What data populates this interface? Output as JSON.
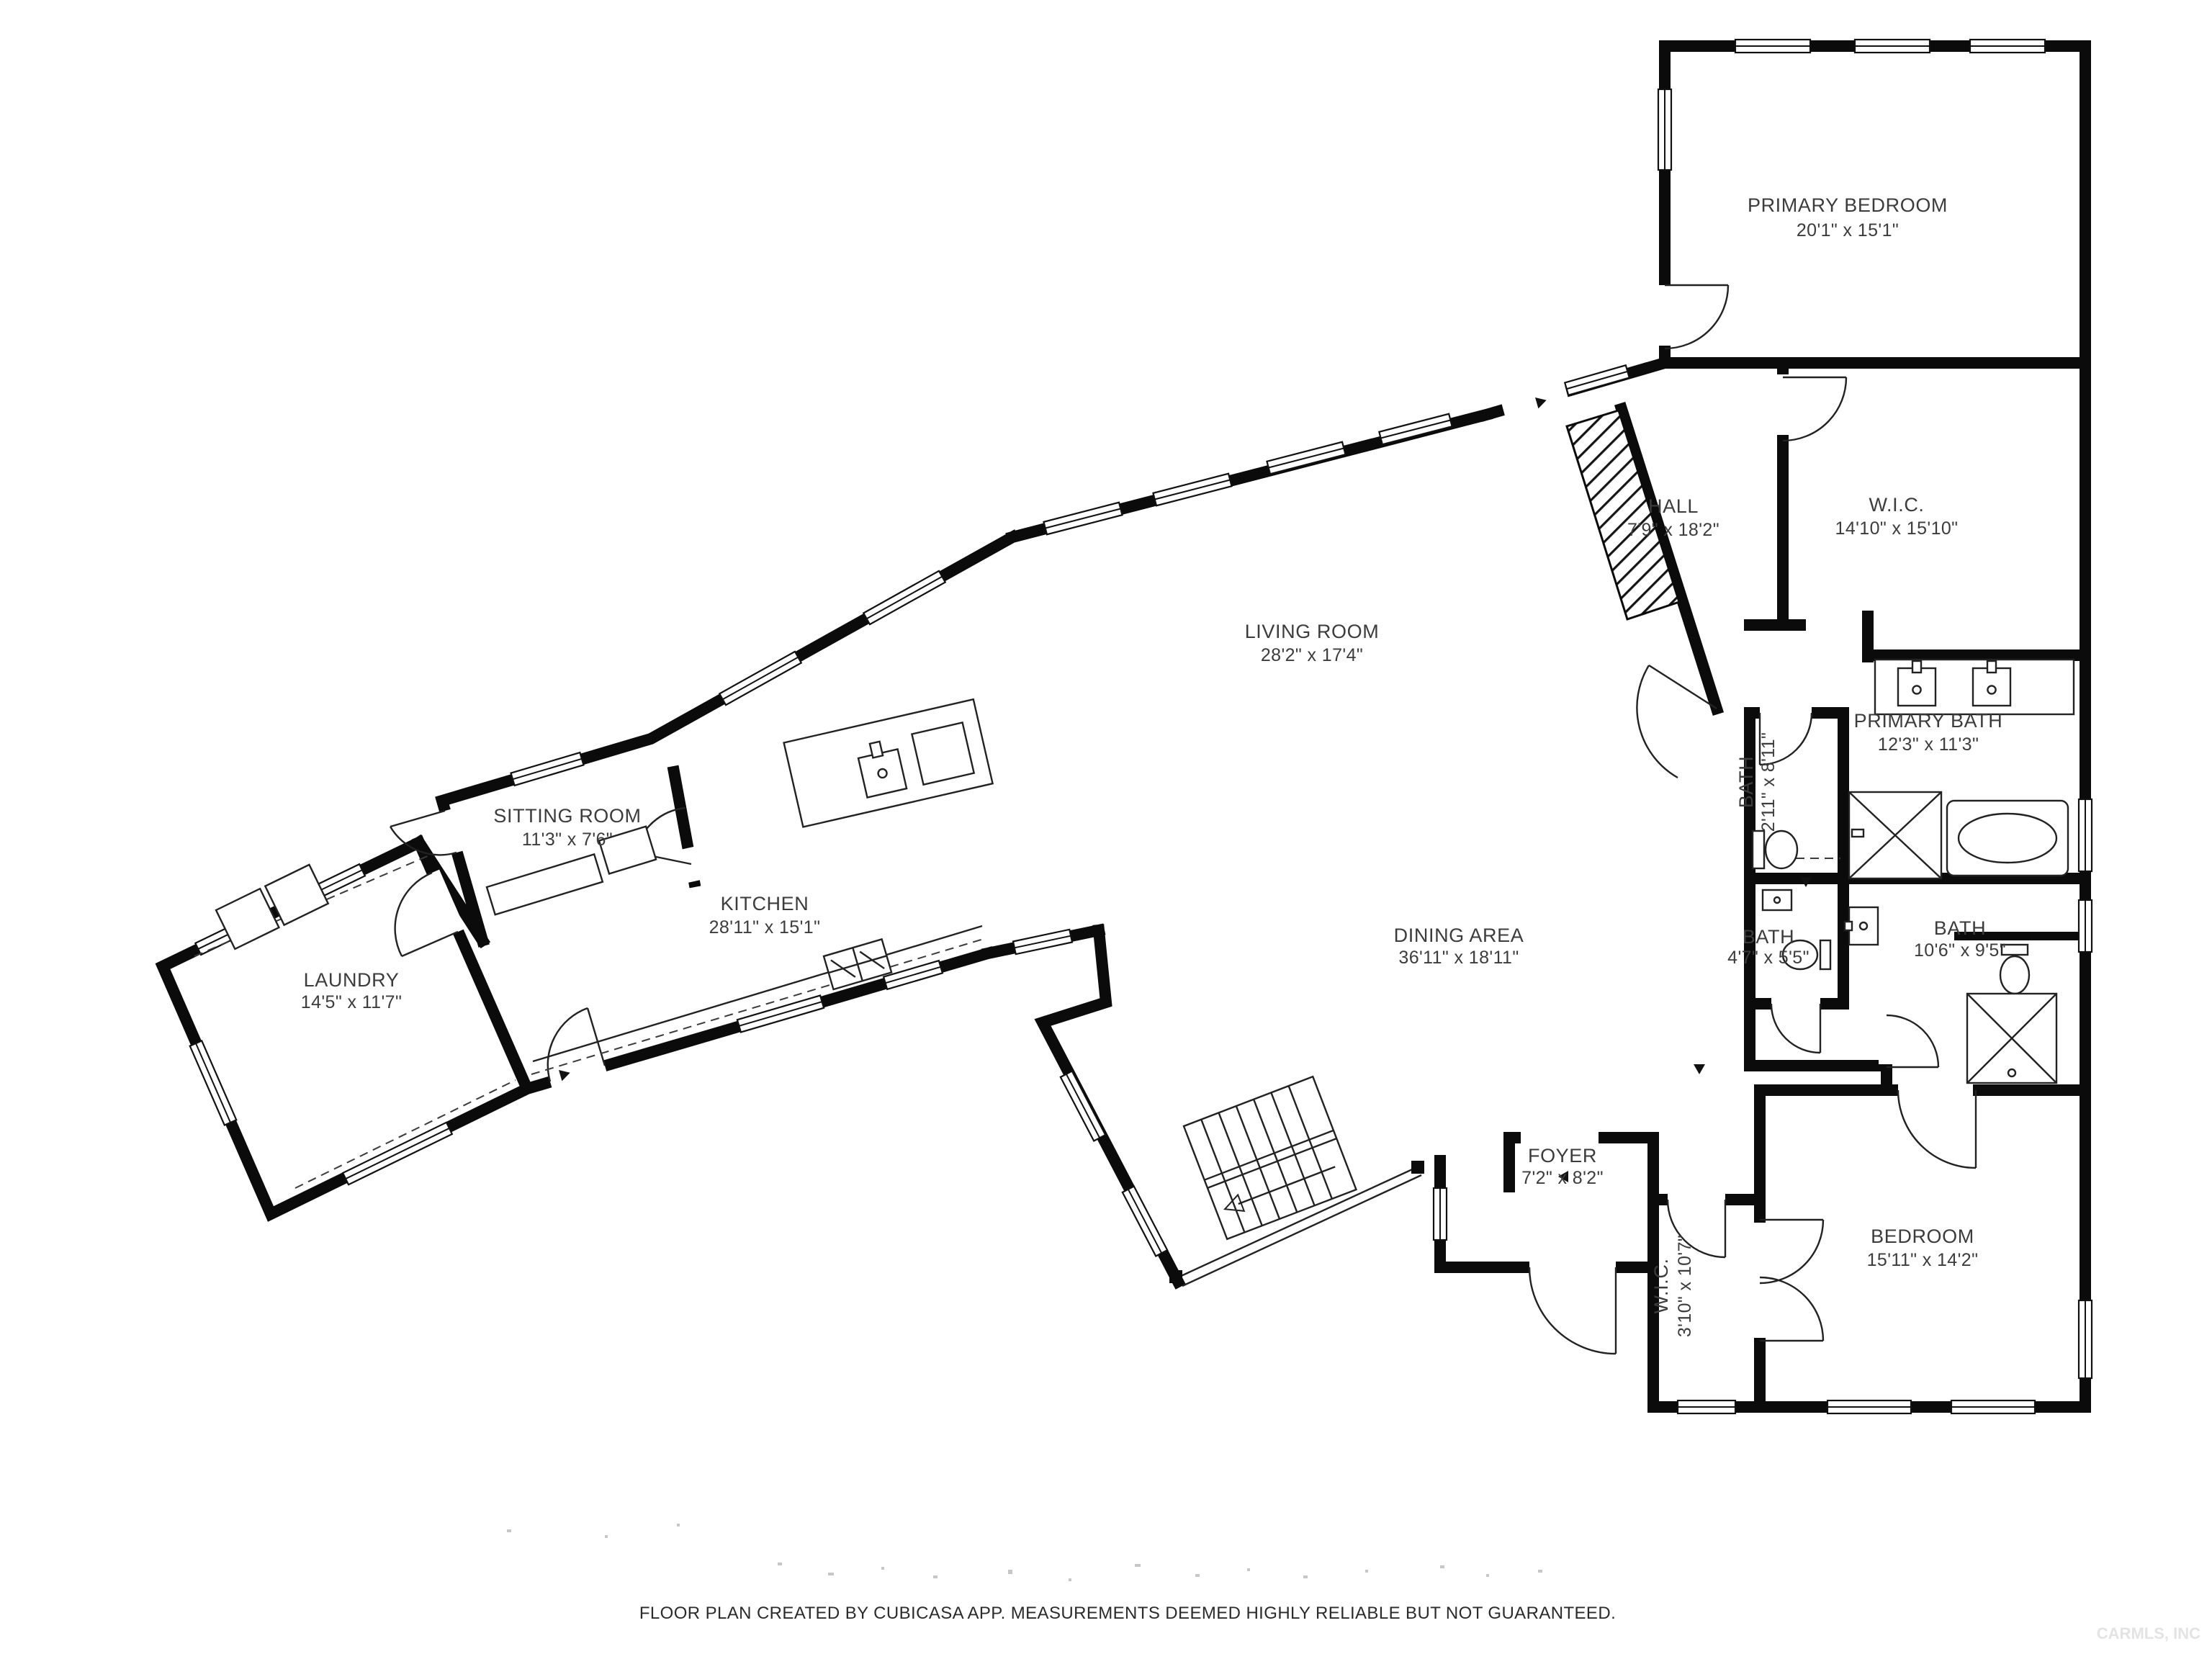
{
  "colors": {
    "wall": "#0b0b0b",
    "label_text": "#3c3c3c",
    "watermark": "#e3e3e3"
  },
  "rooms": [
    {
      "id": "primary-bedroom",
      "name": "PRIMARY BEDROOM",
      "dims": "20'1\" x 15'1\""
    },
    {
      "id": "hall",
      "name": "HALL",
      "dims": "7'9\" x 18'2\""
    },
    {
      "id": "wic",
      "name": "W.I.C.",
      "dims": "14'10\" x 15'10\""
    },
    {
      "id": "living-room",
      "name": "LIVING ROOM",
      "dims": "28'2\" x 17'4\""
    },
    {
      "id": "primary-bath",
      "name": "PRIMARY BATH",
      "dims": "12'3\" x 11'3\""
    },
    {
      "id": "bath-2-11",
      "name": "BATH",
      "dims": "2'11\" x 8'11\""
    },
    {
      "id": "bath-4-7",
      "name": "BATH",
      "dims": "4'7\" x 5'5\""
    },
    {
      "id": "bath-10-6",
      "name": "BATH",
      "dims": "10'6\" x 9'5\""
    },
    {
      "id": "sitting-room",
      "name": "SITTING ROOM",
      "dims": "11'3\" x 7'6\""
    },
    {
      "id": "kitchen",
      "name": "KITCHEN",
      "dims": "28'11\" x 15'1\""
    },
    {
      "id": "laundry",
      "name": "LAUNDRY",
      "dims": "14'5\" x 11'7\""
    },
    {
      "id": "dining-area",
      "name": "DINING AREA",
      "dims": "36'11\" x 18'11\""
    },
    {
      "id": "foyer",
      "name": "FOYER",
      "dims": "7'2\" x 8'2\""
    },
    {
      "id": "wic-2",
      "name": "W.I.C.",
      "dims": "3'10\" x 10'7\""
    },
    {
      "id": "bedroom",
      "name": "BEDROOM",
      "dims": "15'11\" x 14'2\""
    }
  ],
  "footer": {
    "disclaimer": "FLOOR PLAN CREATED BY CUBICASA APP. MEASUREMENTS DEEMED HIGHLY RELIABLE BUT NOT GUARANTEED."
  },
  "watermark": {
    "text": "CARMLS, INC"
  }
}
